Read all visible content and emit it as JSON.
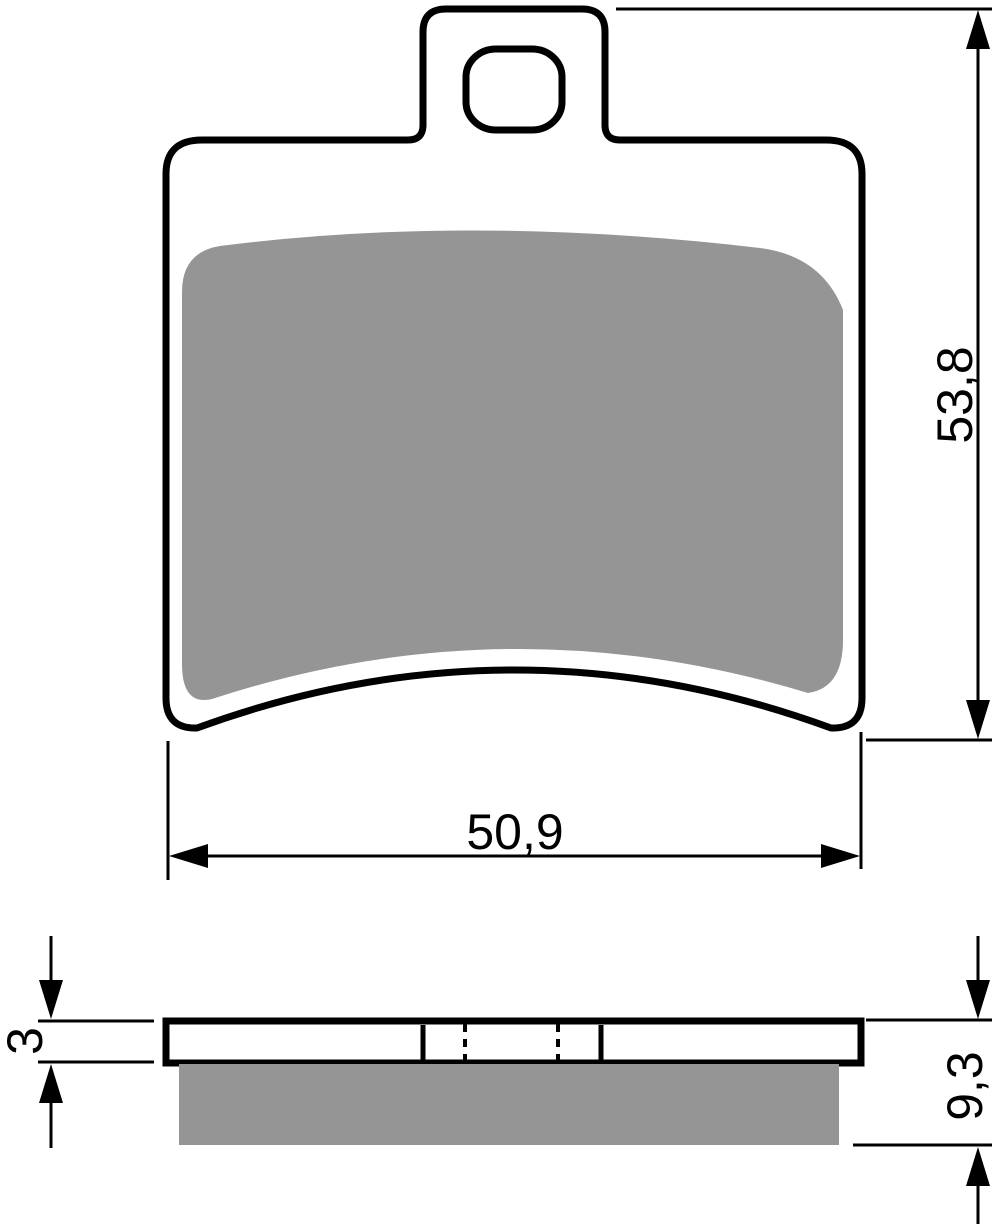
{
  "drawing": {
    "title": "Brake pad technical drawing",
    "colors": {
      "outline": "#000000",
      "friction_material": "#959595",
      "background": "#ffffff"
    },
    "front_view": {
      "width_dimension_label": "50,9",
      "height_dimension_label": "53,8"
    },
    "side_view": {
      "backing_plate_thickness_label": "3",
      "overall_thickness_label": "9,3"
    }
  }
}
